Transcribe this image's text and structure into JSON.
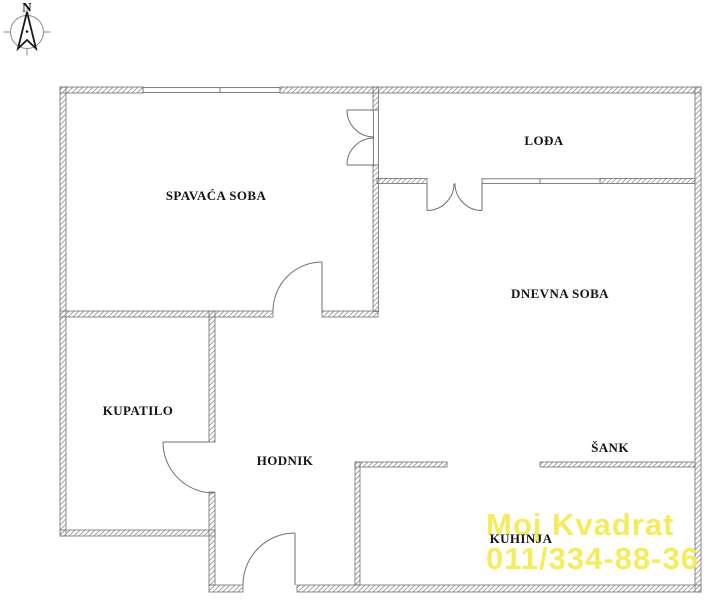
{
  "compass": {
    "label": "N"
  },
  "rooms": [
    {
      "id": "spavaca-soba",
      "label": "SPAVAĆA SOBA"
    },
    {
      "id": "lodja",
      "label": "LOĐA"
    },
    {
      "id": "dnevna-soba",
      "label": "DNEVNA SOBA"
    },
    {
      "id": "kupatilo",
      "label": "KUPATILO"
    },
    {
      "id": "hodnik",
      "label": "HODNIK"
    },
    {
      "id": "sank",
      "label": "ŠANK"
    },
    {
      "id": "kuhinja",
      "label": "KUHINJA"
    }
  ],
  "watermark": {
    "line1": "Moj Kvadrat",
    "line2": "011/334-88-36",
    "color": "#f5ec55"
  },
  "colors": {
    "wall_outline": "#6f6f6f",
    "wall_hatch": "#a3a3a3",
    "door_line": "#6f6f6f",
    "compass_ring": "#8a8a8a",
    "label_text": "#141414",
    "background": "#ffffff"
  }
}
